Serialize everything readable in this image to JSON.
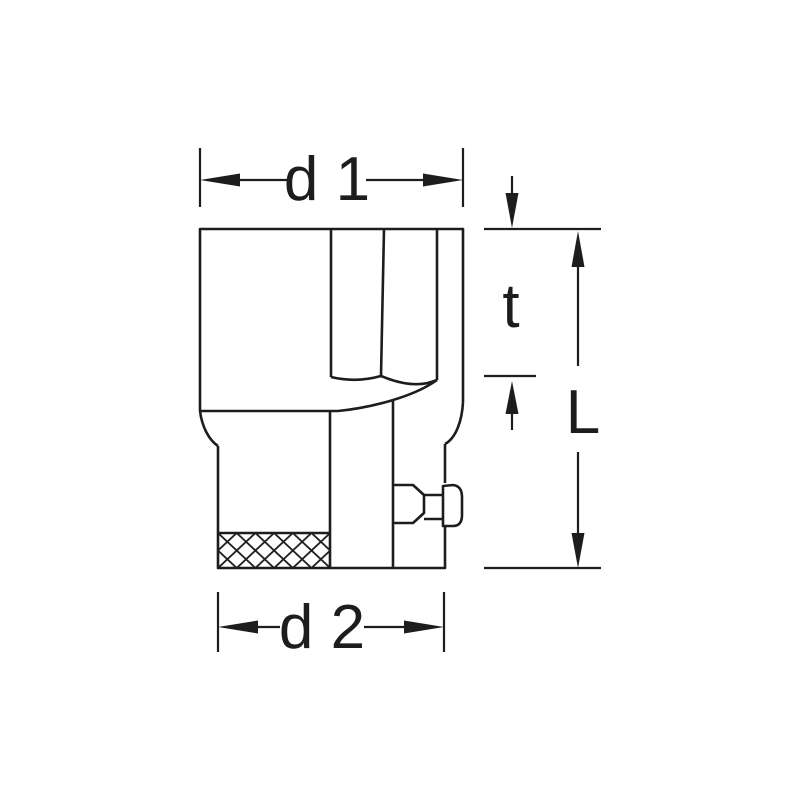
{
  "drawing": {
    "background_color": "#ffffff",
    "line_color": "#1d1d1d",
    "kind": "socket-wrench-technical-drawing",
    "dimension_labels": {
      "top_width": "d 1",
      "bottom_width": "d 2",
      "socket_depth": "t",
      "overall_length": "L"
    }
  }
}
